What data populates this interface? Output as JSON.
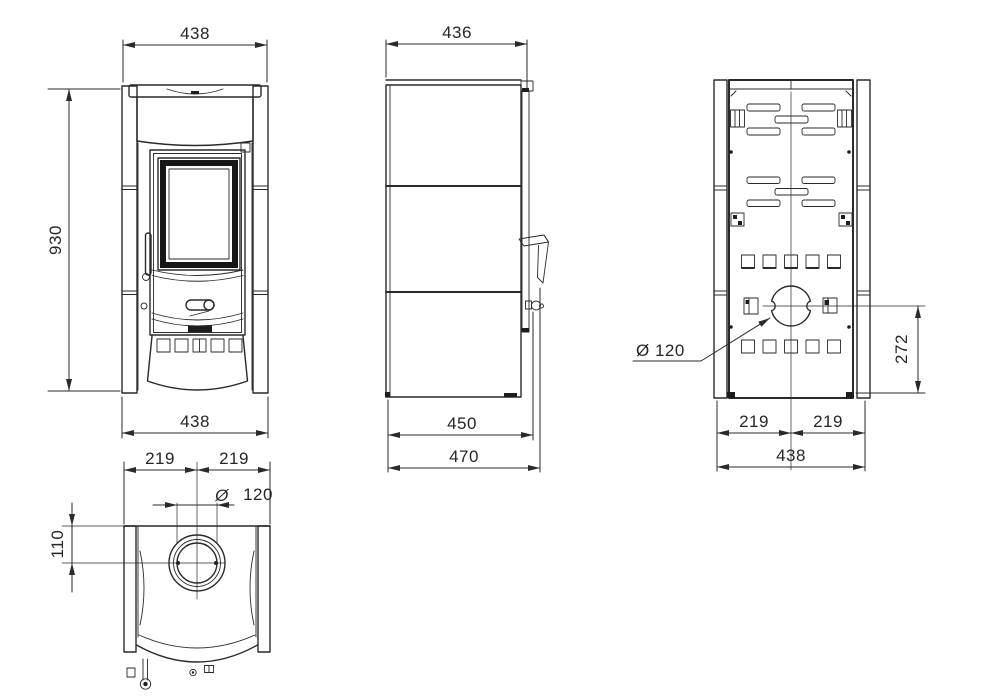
{
  "drawing": {
    "background_color": "#ffffff",
    "line_color": "#2a2a2a",
    "views": {
      "front": {
        "width_top": "438",
        "height": "930",
        "width_bottom": "438"
      },
      "side": {
        "width_top": "436",
        "depth_inner": "450",
        "depth_overall": "470"
      },
      "back": {
        "flue_label": "Ø 120",
        "flue_center_to_base": "272",
        "half_width_left": "219",
        "half_width_right": "219",
        "width": "438"
      },
      "top": {
        "half_width_left": "219",
        "half_width_right": "219",
        "flue_symbol": "Ø",
        "flue_diameter": "120",
        "back_offset": "110"
      }
    }
  }
}
